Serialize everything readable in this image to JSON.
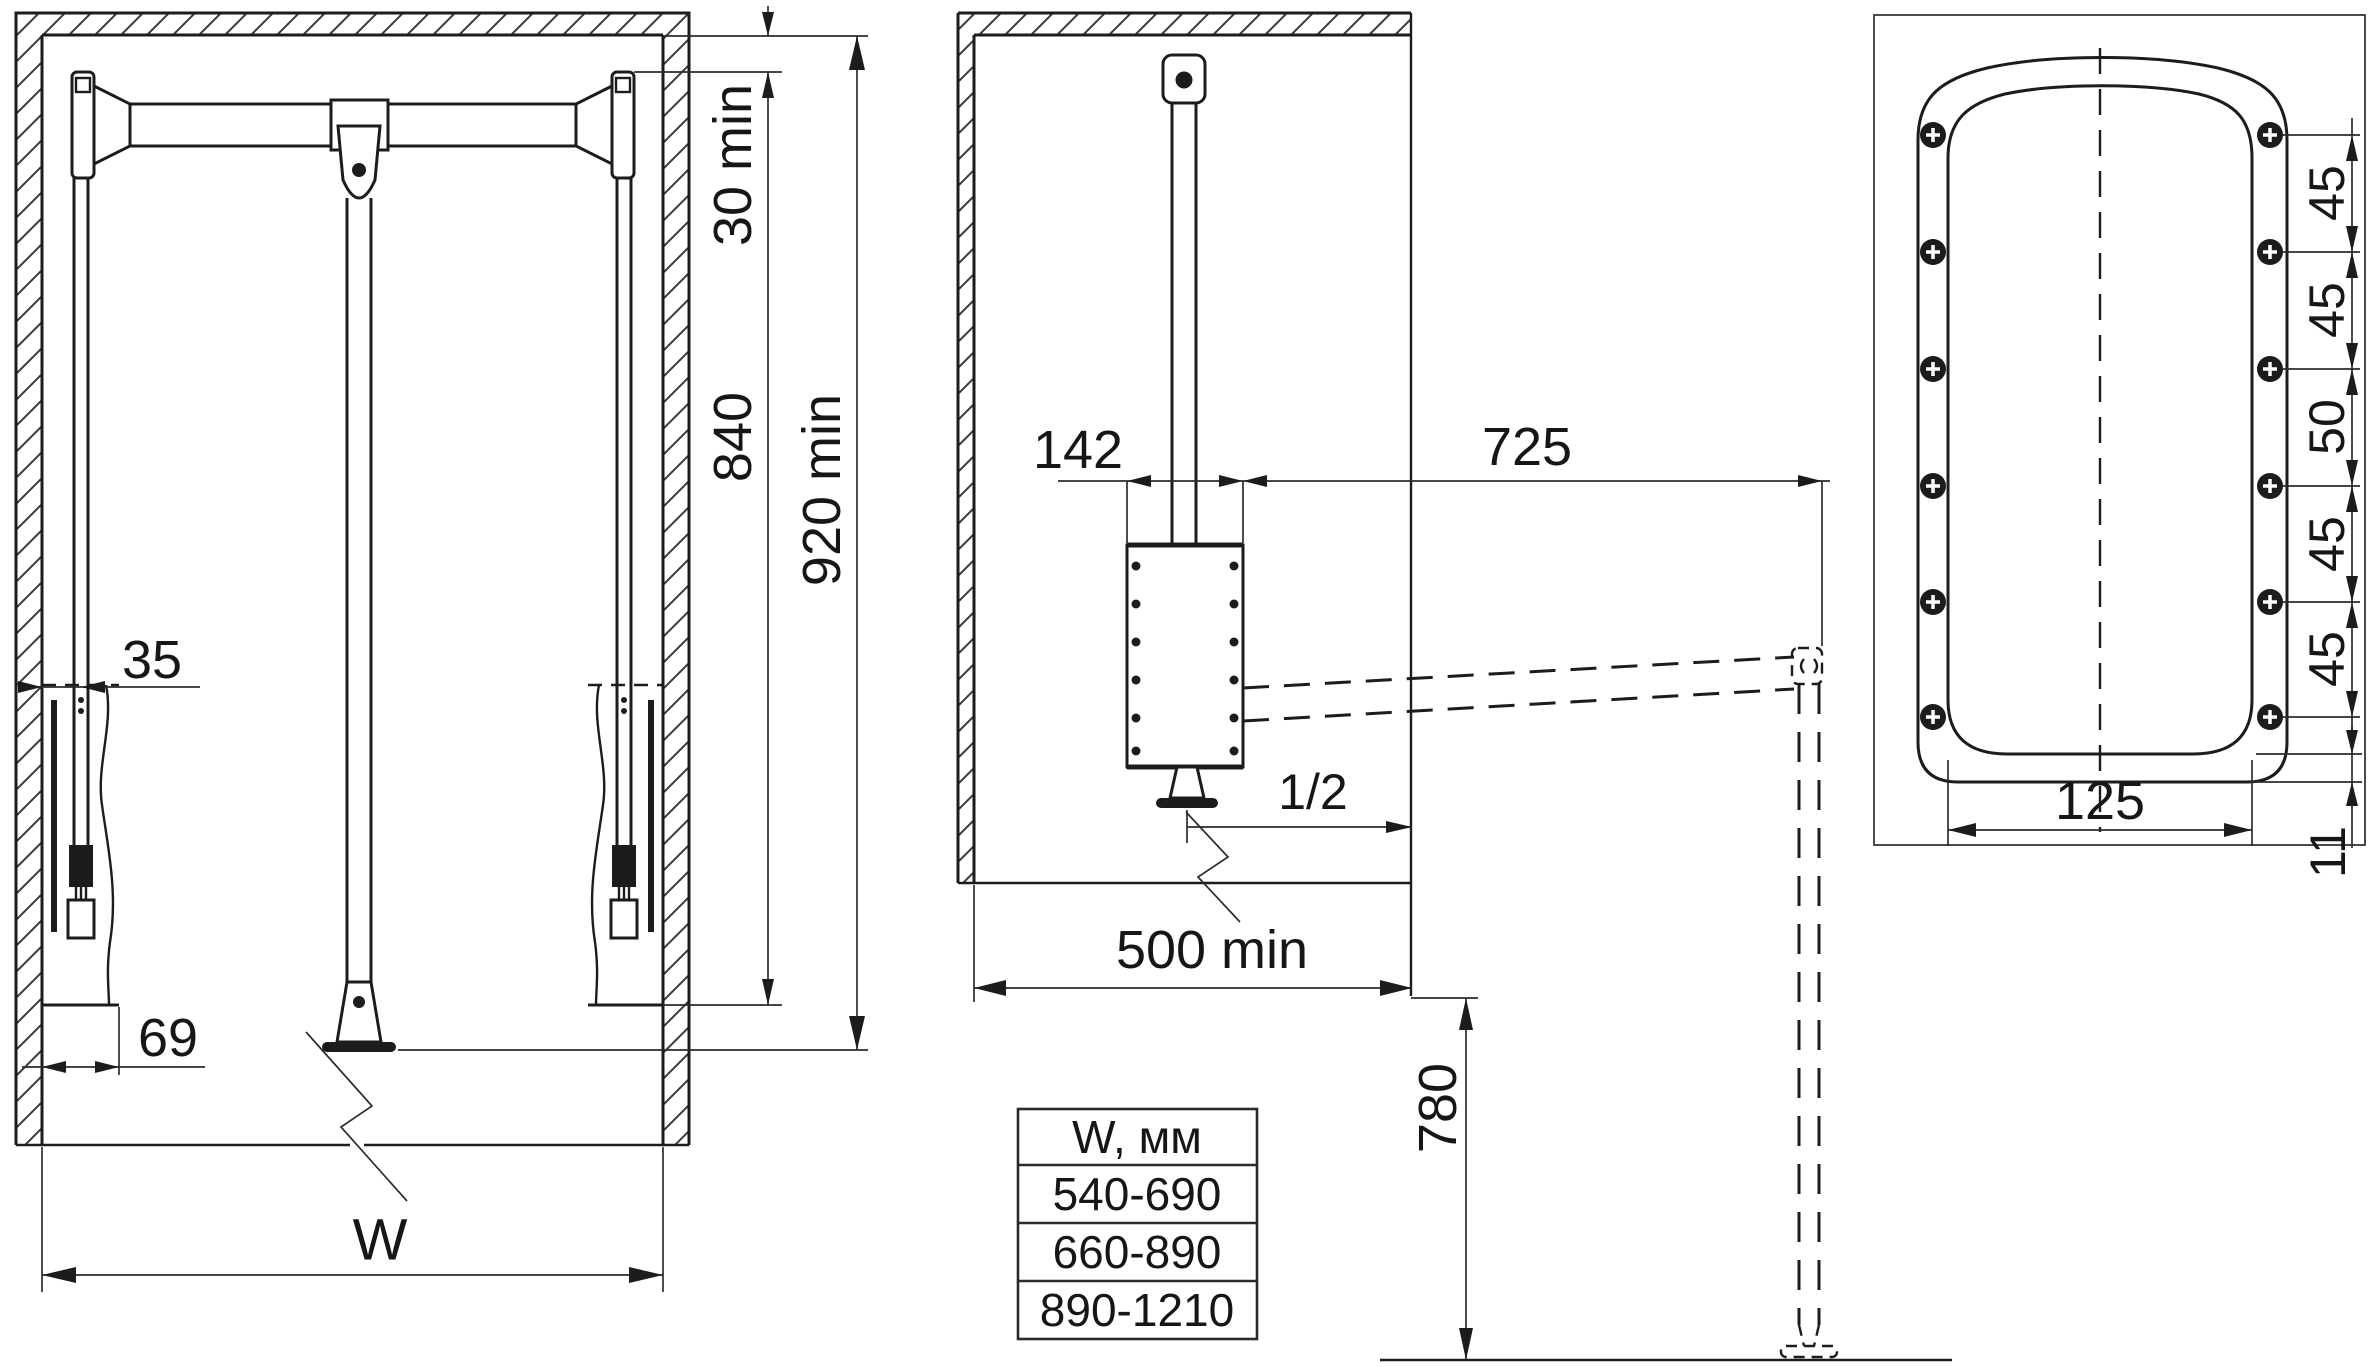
{
  "front": {
    "top_clearance": "30 min",
    "lift_height": "840",
    "min_height": "920 min",
    "arm_offset": "35",
    "arm_width": "69",
    "width": "W"
  },
  "side": {
    "body_width": "142",
    "reach": "725",
    "half": "1/2",
    "min_depth": "500 min",
    "floor_height": "780"
  },
  "plate": {
    "spacings": [
      "45",
      "45",
      "50",
      "45",
      "45"
    ],
    "edge": "11",
    "width": "125"
  },
  "table": {
    "header": "W, мм",
    "rows": [
      "540-690",
      "660-890",
      "890-1210"
    ]
  }
}
